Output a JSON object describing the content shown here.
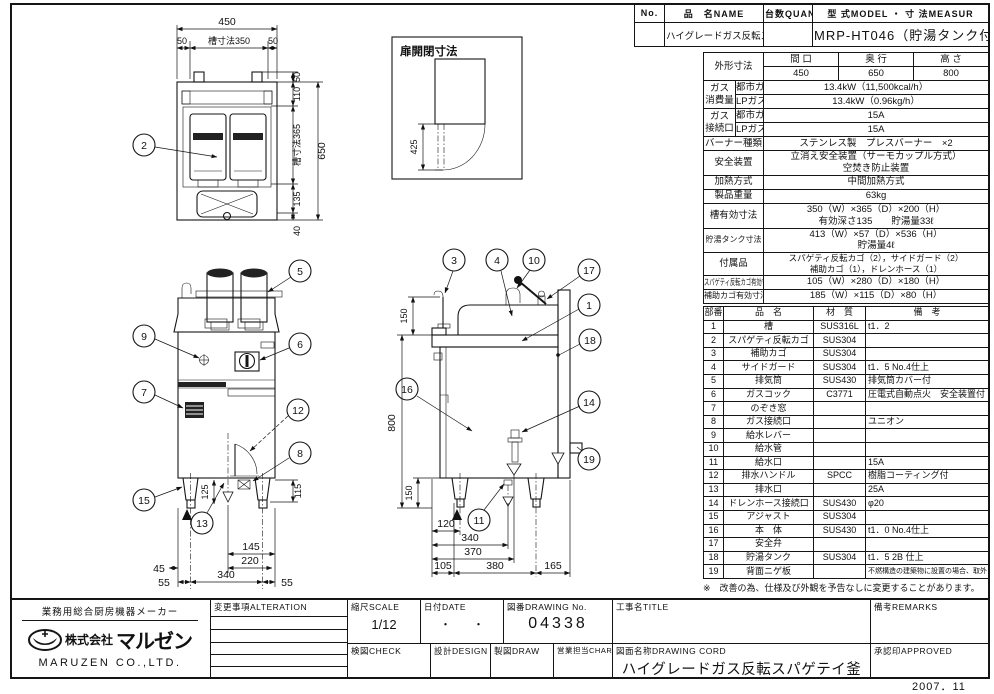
{
  "header": {
    "no_label": "No.",
    "name_label": "品　名NAME",
    "qty_label": "台数QUANTITY",
    "model_label": "型 式MODEL ・ 寸 法MEASUR",
    "name_value": "ハイグレードガス反転スパゲティ釜",
    "model_value": "MRP-HT046（貯湯タンク付）"
  },
  "spec": {
    "outer": {
      "label": "外形寸法",
      "w_label": "間 口",
      "d_label": "奥 行",
      "h_label": "高 さ",
      "w": "450",
      "d": "650",
      "h": "800"
    },
    "gas_consumption": {
      "label1": "ガス",
      "label2": "消費量",
      "city_label": "都市ガス",
      "lp_label": "LPガス",
      "city": "13.4kW（11,500kcal/h）",
      "lp": "13.4kW（0.96kg/h）"
    },
    "gas_connection": {
      "label1": "ガス",
      "label2": "接続口",
      "city_label": "都市ガス",
      "lp_label": "LPガス",
      "city": "15A",
      "lp": "15A"
    },
    "burner": {
      "label": "バーナー種類",
      "value": "ステンレス製　プレスバーナー　×2"
    },
    "safety": {
      "label": "安全装置",
      "line1": "立消え安全装置（サーモカップル方式）",
      "line2": "空焚き防止装置"
    },
    "heating": {
      "label": "加熱方式",
      "value": "中間加熱方式"
    },
    "weight": {
      "label": "製品重量",
      "value": "63kg"
    },
    "tank_dim": {
      "label": "槽有効寸法",
      "line1": "350（W）×365（D）×200（H）",
      "line2": "有効深さ135　　貯湯量33ℓ"
    },
    "hot_tank": {
      "label": "貯湯タンク寸法",
      "line1": "413（W）×57（D）×536（H）",
      "line2": "貯湯量4ℓ"
    },
    "accessories": {
      "label": "付属品",
      "line1": "スパゲティ反転カゴ（2），サイドガード（2）",
      "line2": "補助カゴ（1），ドレンホース（1）"
    },
    "basket_dim": {
      "label": "スパゲティ反転カゴ有効寸法",
      "value": "105（W）×280（D）×180（H）"
    },
    "sub_basket_dim": {
      "label": "補助カゴ有効寸法",
      "value": "185（W）×115（D）×80（H）"
    }
  },
  "parts": {
    "headers": [
      "部番",
      "品　名",
      "材　質",
      "備　考"
    ],
    "rows": [
      [
        "1",
        "槽",
        "SUS316L",
        "t1．2"
      ],
      [
        "2",
        "スパゲティ反転カゴ",
        "SUS304",
        ""
      ],
      [
        "3",
        "補助カゴ",
        "SUS304",
        ""
      ],
      [
        "4",
        "サイドガード",
        "SUS304",
        "t1．5 No.4仕上"
      ],
      [
        "5",
        "排気筒",
        "SUS430",
        "排気筒カバー付"
      ],
      [
        "6",
        "ガスコック",
        "C3771",
        "圧電式自動点火　安全装置付"
      ],
      [
        "7",
        "のぞき窓",
        "",
        ""
      ],
      [
        "8",
        "ガス接続口",
        "",
        "ユニオン"
      ],
      [
        "9",
        "給水レバー",
        "",
        ""
      ],
      [
        "10",
        "給水管",
        "",
        ""
      ],
      [
        "11",
        "給水口",
        "",
        "15A"
      ],
      [
        "12",
        "排水ハンドル",
        "SPCC",
        "樹脂コーティング付"
      ],
      [
        "13",
        "排水口",
        "",
        "25A"
      ],
      [
        "14",
        "ドレンホース接続口",
        "SUS430",
        "φ20"
      ],
      [
        "15",
        "アジャスト",
        "SUS304",
        ""
      ],
      [
        "16",
        "本　体",
        "SUS430",
        "t1．0 No.4仕上"
      ],
      [
        "17",
        "安全弁",
        "",
        ""
      ],
      [
        "18",
        "貯湯タンク",
        "SUS304",
        "t1．5 2B 仕上"
      ],
      [
        "19",
        "背面ニゲ板",
        "",
        "不燃構造の建築物に設置の場合、取外し可"
      ]
    ],
    "note": "※　改善の為、仕様及び外観を予告なしに変更することがあります。"
  },
  "titleblock": {
    "maker_tagline": "業務用総合厨房機器メーカー",
    "company_prefix": "株式会社",
    "company_jp": "マルゼン",
    "company_en": "MARUZEN  CO.,LTD.",
    "alteration_label": "変更事項ALTERATION",
    "scale_label": "縮尺SCALE",
    "scale_value": "1/12",
    "date_label": "日付DATE",
    "date_value": "・　　・",
    "drawing_no_label": "図番DRAWING  No.",
    "drawing_no_value": "04338",
    "title_label": "工事名TITLE",
    "remarks_label": "備考REMARKS",
    "check_label": "検図CHECK",
    "design_label": "設計DESIGN",
    "draw_label": "製図DRAW",
    "charge_label": "営業担当CHARGE",
    "drawing_name_label": "図面名称DRAWING  CORD",
    "drawing_name_value": "ハイグレードガス反転スパゲテイ釜",
    "approved_label": "承認印APPROVED",
    "date_stamp": "2007．11"
  },
  "drawing": {
    "plan": {
      "dim_450": "450",
      "dim_tank_w": "槽寸法350",
      "dim_50l": "50",
      "dim_50r": "50",
      "dim_50t": "50",
      "dim_110": "110",
      "dim_tank_d": "槽寸法365",
      "dim_650": "650",
      "dim_135": "135",
      "dim_40": "40",
      "callout_2": "2"
    },
    "door": {
      "title": "扉開閉寸法",
      "dim_425": "425"
    },
    "front": {
      "callout_5": "5",
      "callout_9": "9",
      "callout_6": "6",
      "callout_7": "7",
      "callout_12": "12",
      "callout_8": "8",
      "callout_13": "13",
      "callout_15": "15",
      "dim_125": "125",
      "dim_115": "115",
      "dim_145": "145",
      "dim_220": "220",
      "dim_45": "45",
      "dim_55l": "55",
      "dim_340": "340",
      "dim_55r": "55"
    },
    "side": {
      "callout_3": "3",
      "callout_4": "4",
      "callout_10": "10",
      "callout_17": "17",
      "callout_1": "1",
      "callout_18": "18",
      "callout_16": "16",
      "callout_14": "14",
      "callout_19": "19",
      "callout_11": "11",
      "dim_150t": "150",
      "dim_800": "800",
      "dim_150b": "150",
      "dim_120": "120",
      "dim_340": "340",
      "dim_370": "370",
      "dim_105": "105",
      "dim_380": "380",
      "dim_165": "165"
    }
  }
}
